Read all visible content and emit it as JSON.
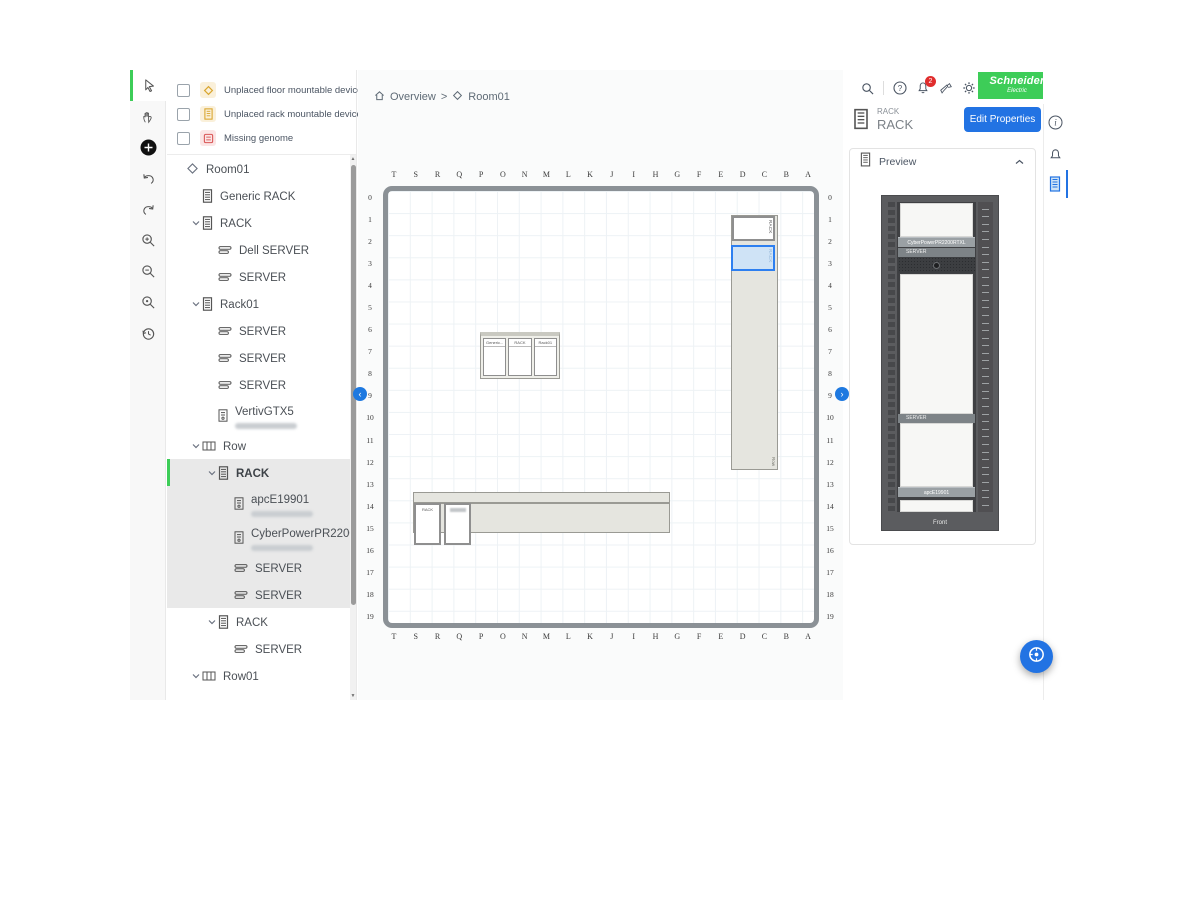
{
  "brand": {
    "line1": "Schneider",
    "line2": "Electric",
    "green": "#3dcd58"
  },
  "toolbar": {
    "tools": [
      "select",
      "pan",
      "add",
      "undo",
      "redo",
      "zoom-in",
      "zoom-out",
      "zoom-fit",
      "history"
    ]
  },
  "filters": {
    "items": [
      {
        "label": "Unplaced floor mountable devices",
        "icon": "floor-device",
        "chip_bg": "#faf0da",
        "tint": "#d9a62e"
      },
      {
        "label": "Unplaced rack mountable devices",
        "icon": "rack-device",
        "chip_bg": "#faf0da",
        "tint": "#d9a62e"
      },
      {
        "label": "Missing genome",
        "icon": "missing-genome",
        "chip_bg": "#fbe5e5",
        "tint": "#d95757"
      }
    ]
  },
  "tree": {
    "items": [
      {
        "label": "Room01",
        "icon": "room",
        "depth": 0,
        "expandable": false
      },
      {
        "label": "Generic RACK",
        "icon": "rack",
        "depth": 1,
        "expandable": false
      },
      {
        "label": "RACK",
        "icon": "rack",
        "depth": 1,
        "expandable": true
      },
      {
        "label": "Dell SERVER",
        "icon": "server",
        "depth": 2,
        "expandable": false
      },
      {
        "label": "SERVER",
        "icon": "server",
        "depth": 2,
        "expandable": false
      },
      {
        "label": "Rack01",
        "icon": "rack",
        "depth": 1,
        "expandable": true
      },
      {
        "label": "SERVER",
        "icon": "server",
        "depth": 2,
        "expandable": false
      },
      {
        "label": "SERVER",
        "icon": "server",
        "depth": 2,
        "expandable": false
      },
      {
        "label": "SERVER",
        "icon": "server",
        "depth": 2,
        "expandable": false
      },
      {
        "label": "VertivGTX5",
        "icon": "ups",
        "depth": 2,
        "expandable": false,
        "redacted_subtitle": true
      },
      {
        "label": "Row",
        "icon": "row",
        "depth": 1,
        "expandable": true
      },
      {
        "label": "RACK",
        "icon": "rack",
        "depth": 2,
        "expandable": true,
        "selected": true,
        "in_selection": true
      },
      {
        "label": "apcE19901",
        "icon": "ups",
        "depth": 3,
        "expandable": false,
        "redacted_subtitle": true,
        "in_selection": true
      },
      {
        "label": "CyberPowerPR2200R...",
        "icon": "ups",
        "depth": 3,
        "expandable": false,
        "redacted_subtitle": true,
        "in_selection": true
      },
      {
        "label": "SERVER",
        "icon": "server",
        "depth": 3,
        "expandable": false,
        "in_selection": true
      },
      {
        "label": "SERVER",
        "icon": "server",
        "depth": 3,
        "expandable": false,
        "in_selection": true
      },
      {
        "label": "RACK",
        "icon": "rack",
        "depth": 2,
        "expandable": true
      },
      {
        "label": "SERVER",
        "icon": "server",
        "depth": 3,
        "expandable": false
      },
      {
        "label": "Row01",
        "icon": "row",
        "depth": 1,
        "expandable": true
      }
    ]
  },
  "breadcrumb": {
    "section": "Overview",
    "separator": ">",
    "page": "Room01"
  },
  "canvas": {
    "columns": [
      "T",
      "S",
      "R",
      "Q",
      "P",
      "O",
      "N",
      "M",
      "L",
      "K",
      "J",
      "I",
      "H",
      "G",
      "F",
      "E",
      "D",
      "C",
      "B",
      "A"
    ],
    "rows": [
      "0",
      "1",
      "2",
      "3",
      "4",
      "5",
      "6",
      "7",
      "8",
      "9",
      "10",
      "11",
      "12",
      "13",
      "14",
      "15",
      "16",
      "17",
      "18",
      "19"
    ],
    "vertical_row": {
      "label": "Row",
      "rack_top_label": "RACK",
      "rack_selected_label": "RACK"
    },
    "rack_group": {
      "labels": [
        "Generic...",
        "RACK",
        "Rack01"
      ]
    },
    "horizontal_row": {
      "label": "Row01",
      "rack_label": "RACK",
      "second_rack_redacted": true
    }
  },
  "topbar": {
    "notification_count": "2"
  },
  "inspector": {
    "type_label": "RACK",
    "name": "RACK",
    "edit_button": "Edit Properties",
    "preview": {
      "title": "Preview",
      "devices": [
        {
          "label": "CyberPowerPR2200RTXL"
        },
        {
          "label": "SERVER"
        },
        {
          "label": "SERVER"
        },
        {
          "label": "apcE19901"
        }
      ],
      "front_label": "Front"
    }
  }
}
